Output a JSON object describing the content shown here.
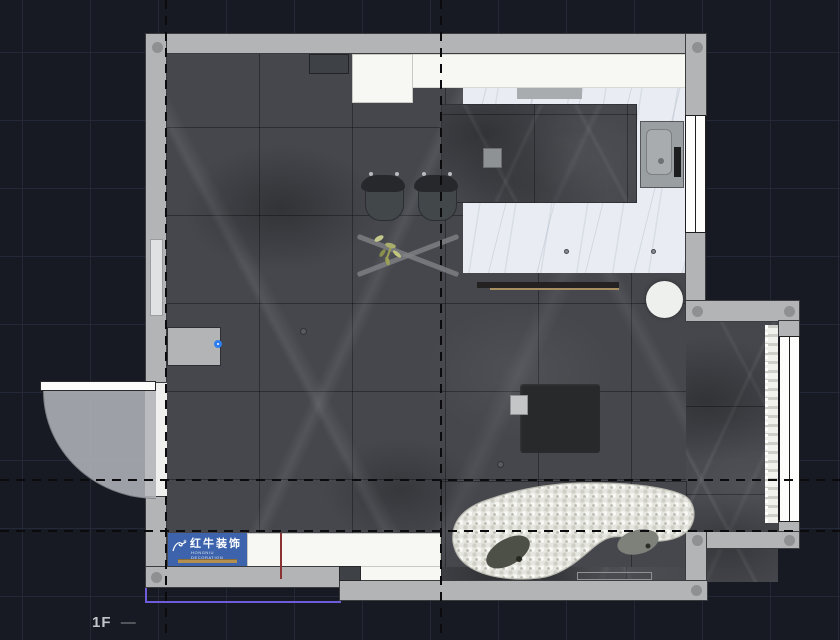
{
  "app": {
    "floor_label": "1F",
    "floor_label_dash": "—"
  },
  "watermark": {
    "title": "红牛装饰",
    "subtitle": "HONGNIU DECORATION",
    "bg_color": "#3c63ac",
    "accent_bar_color": "#b3904f"
  },
  "colors": {
    "background": "#171a23",
    "grid": "#242938",
    "wall": "#b2b4b6",
    "floor_dark_marble": "#45474c",
    "floor_light_marble": "#e9edf3",
    "guide_dash": "#0b0b0d",
    "selection_purple": "#6f5cdb",
    "reference_red": "#8b3333",
    "marker_blue": "#2d7ef0"
  },
  "objects": [
    "wardrobe",
    "refrigerator",
    "kitchen-counter",
    "range-hood",
    "kitchen-island",
    "hob",
    "sink",
    "bar-shelf",
    "round-table",
    "dining-chair",
    "dining-chair",
    "x-base-table",
    "plant",
    "coffee-table",
    "side-block",
    "curved-sofa",
    "pillow",
    "pillow",
    "tv-board",
    "entry-door",
    "window-right-top",
    "window-right-bottom",
    "curtain",
    "wall-niche",
    "wall-protrusion"
  ]
}
